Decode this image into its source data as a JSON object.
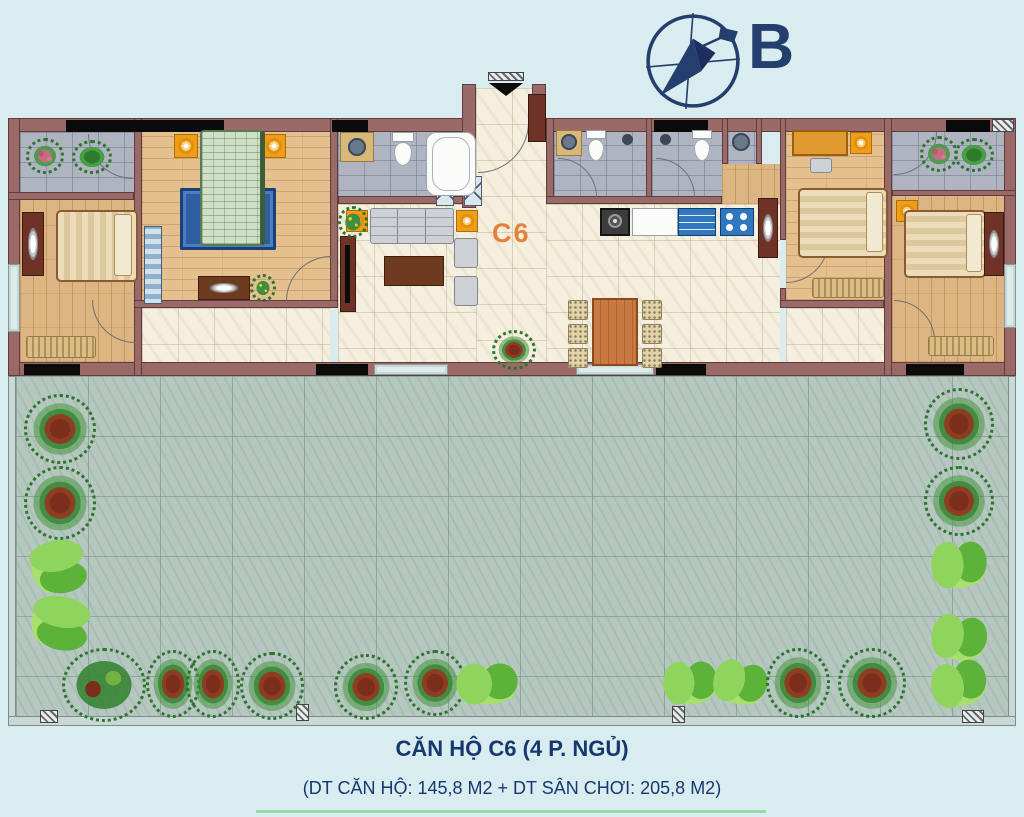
{
  "compass": {
    "label": "B"
  },
  "plan": {
    "unit_label": "C6"
  },
  "footer": {
    "title": "CĂN HỘ C6 (4 P. NGỦ)",
    "subtitle": "(DT CĂN HỘ: 145,8 M2   +   DT SÂN CHƠI: 205,8 M2)"
  },
  "colors": {
    "background": "#d9edf0",
    "wall": "#9a6a68",
    "navy_text": "#16386e",
    "unit_label_orange": "#e5813a",
    "wood_floor": "#dcb582",
    "cream_tile": "#f4efdf",
    "gray_tile": "#aeb5c1",
    "terrace_tile": "#b5c7bf",
    "rug_blue": "#2e5da0",
    "kitchen_blue": "#2f78c0",
    "plant_green": "#3c8c3c",
    "plant_red": "#7c2e1c"
  },
  "plants": [
    {
      "t": "bush",
      "x": 24,
      "y": 394,
      "w": 66,
      "h": 64
    },
    {
      "t": "bush",
      "x": 24,
      "y": 466,
      "w": 66,
      "h": 68
    },
    {
      "t": "fern",
      "x": 30,
      "y": 538,
      "w": 56,
      "h": 58,
      "r": 80
    },
    {
      "t": "fern",
      "x": 32,
      "y": 592,
      "w": 56,
      "h": 62,
      "r": 100
    },
    {
      "t": "bushmix",
      "x": 62,
      "y": 648,
      "w": 78,
      "h": 68
    },
    {
      "t": "bush",
      "x": 146,
      "y": 650,
      "w": 48,
      "h": 62
    },
    {
      "t": "bush",
      "x": 186,
      "y": 650,
      "w": 48,
      "h": 62
    },
    {
      "t": "bush",
      "x": 240,
      "y": 652,
      "w": 58,
      "h": 62
    },
    {
      "t": "bush",
      "x": 334,
      "y": 654,
      "w": 58,
      "h": 60
    },
    {
      "t": "bush",
      "x": 404,
      "y": 650,
      "w": 56,
      "h": 60
    },
    {
      "t": "fern",
      "x": 455,
      "y": 662,
      "w": 64,
      "h": 44
    },
    {
      "t": "fern",
      "x": 662,
      "y": 660,
      "w": 56,
      "h": 46
    },
    {
      "t": "fern",
      "x": 712,
      "y": 660,
      "w": 56,
      "h": 46,
      "r": 15
    },
    {
      "t": "bush",
      "x": 766,
      "y": 648,
      "w": 58,
      "h": 64
    },
    {
      "t": "bush",
      "x": 838,
      "y": 648,
      "w": 62,
      "h": 64
    },
    {
      "t": "bush",
      "x": 924,
      "y": 388,
      "w": 64,
      "h": 66
    },
    {
      "t": "bush",
      "x": 924,
      "y": 466,
      "w": 64,
      "h": 64
    },
    {
      "t": "fern",
      "x": 930,
      "y": 540,
      "w": 58,
      "h": 50
    },
    {
      "t": "fern",
      "x": 930,
      "y": 614,
      "w": 58,
      "h": 48,
      "r": 10
    },
    {
      "t": "fern",
      "x": 930,
      "y": 660,
      "w": 58,
      "h": 48,
      "r": -10
    },
    {
      "t": "flower",
      "x": 26,
      "y": 138,
      "w": 32,
      "h": 30
    },
    {
      "t": "green",
      "x": 72,
      "y": 140,
      "w": 34,
      "h": 28
    },
    {
      "t": "flower",
      "x": 920,
      "y": 136,
      "w": 32,
      "h": 30
    },
    {
      "t": "green",
      "x": 954,
      "y": 138,
      "w": 34,
      "h": 28
    },
    {
      "t": "bush",
      "x": 492,
      "y": 330,
      "w": 38,
      "h": 34
    },
    {
      "t": "yellow",
      "x": 338,
      "y": 206,
      "w": 24,
      "h": 26
    },
    {
      "t": "yellow",
      "x": 250,
      "y": 274,
      "w": 20,
      "h": 22
    }
  ]
}
